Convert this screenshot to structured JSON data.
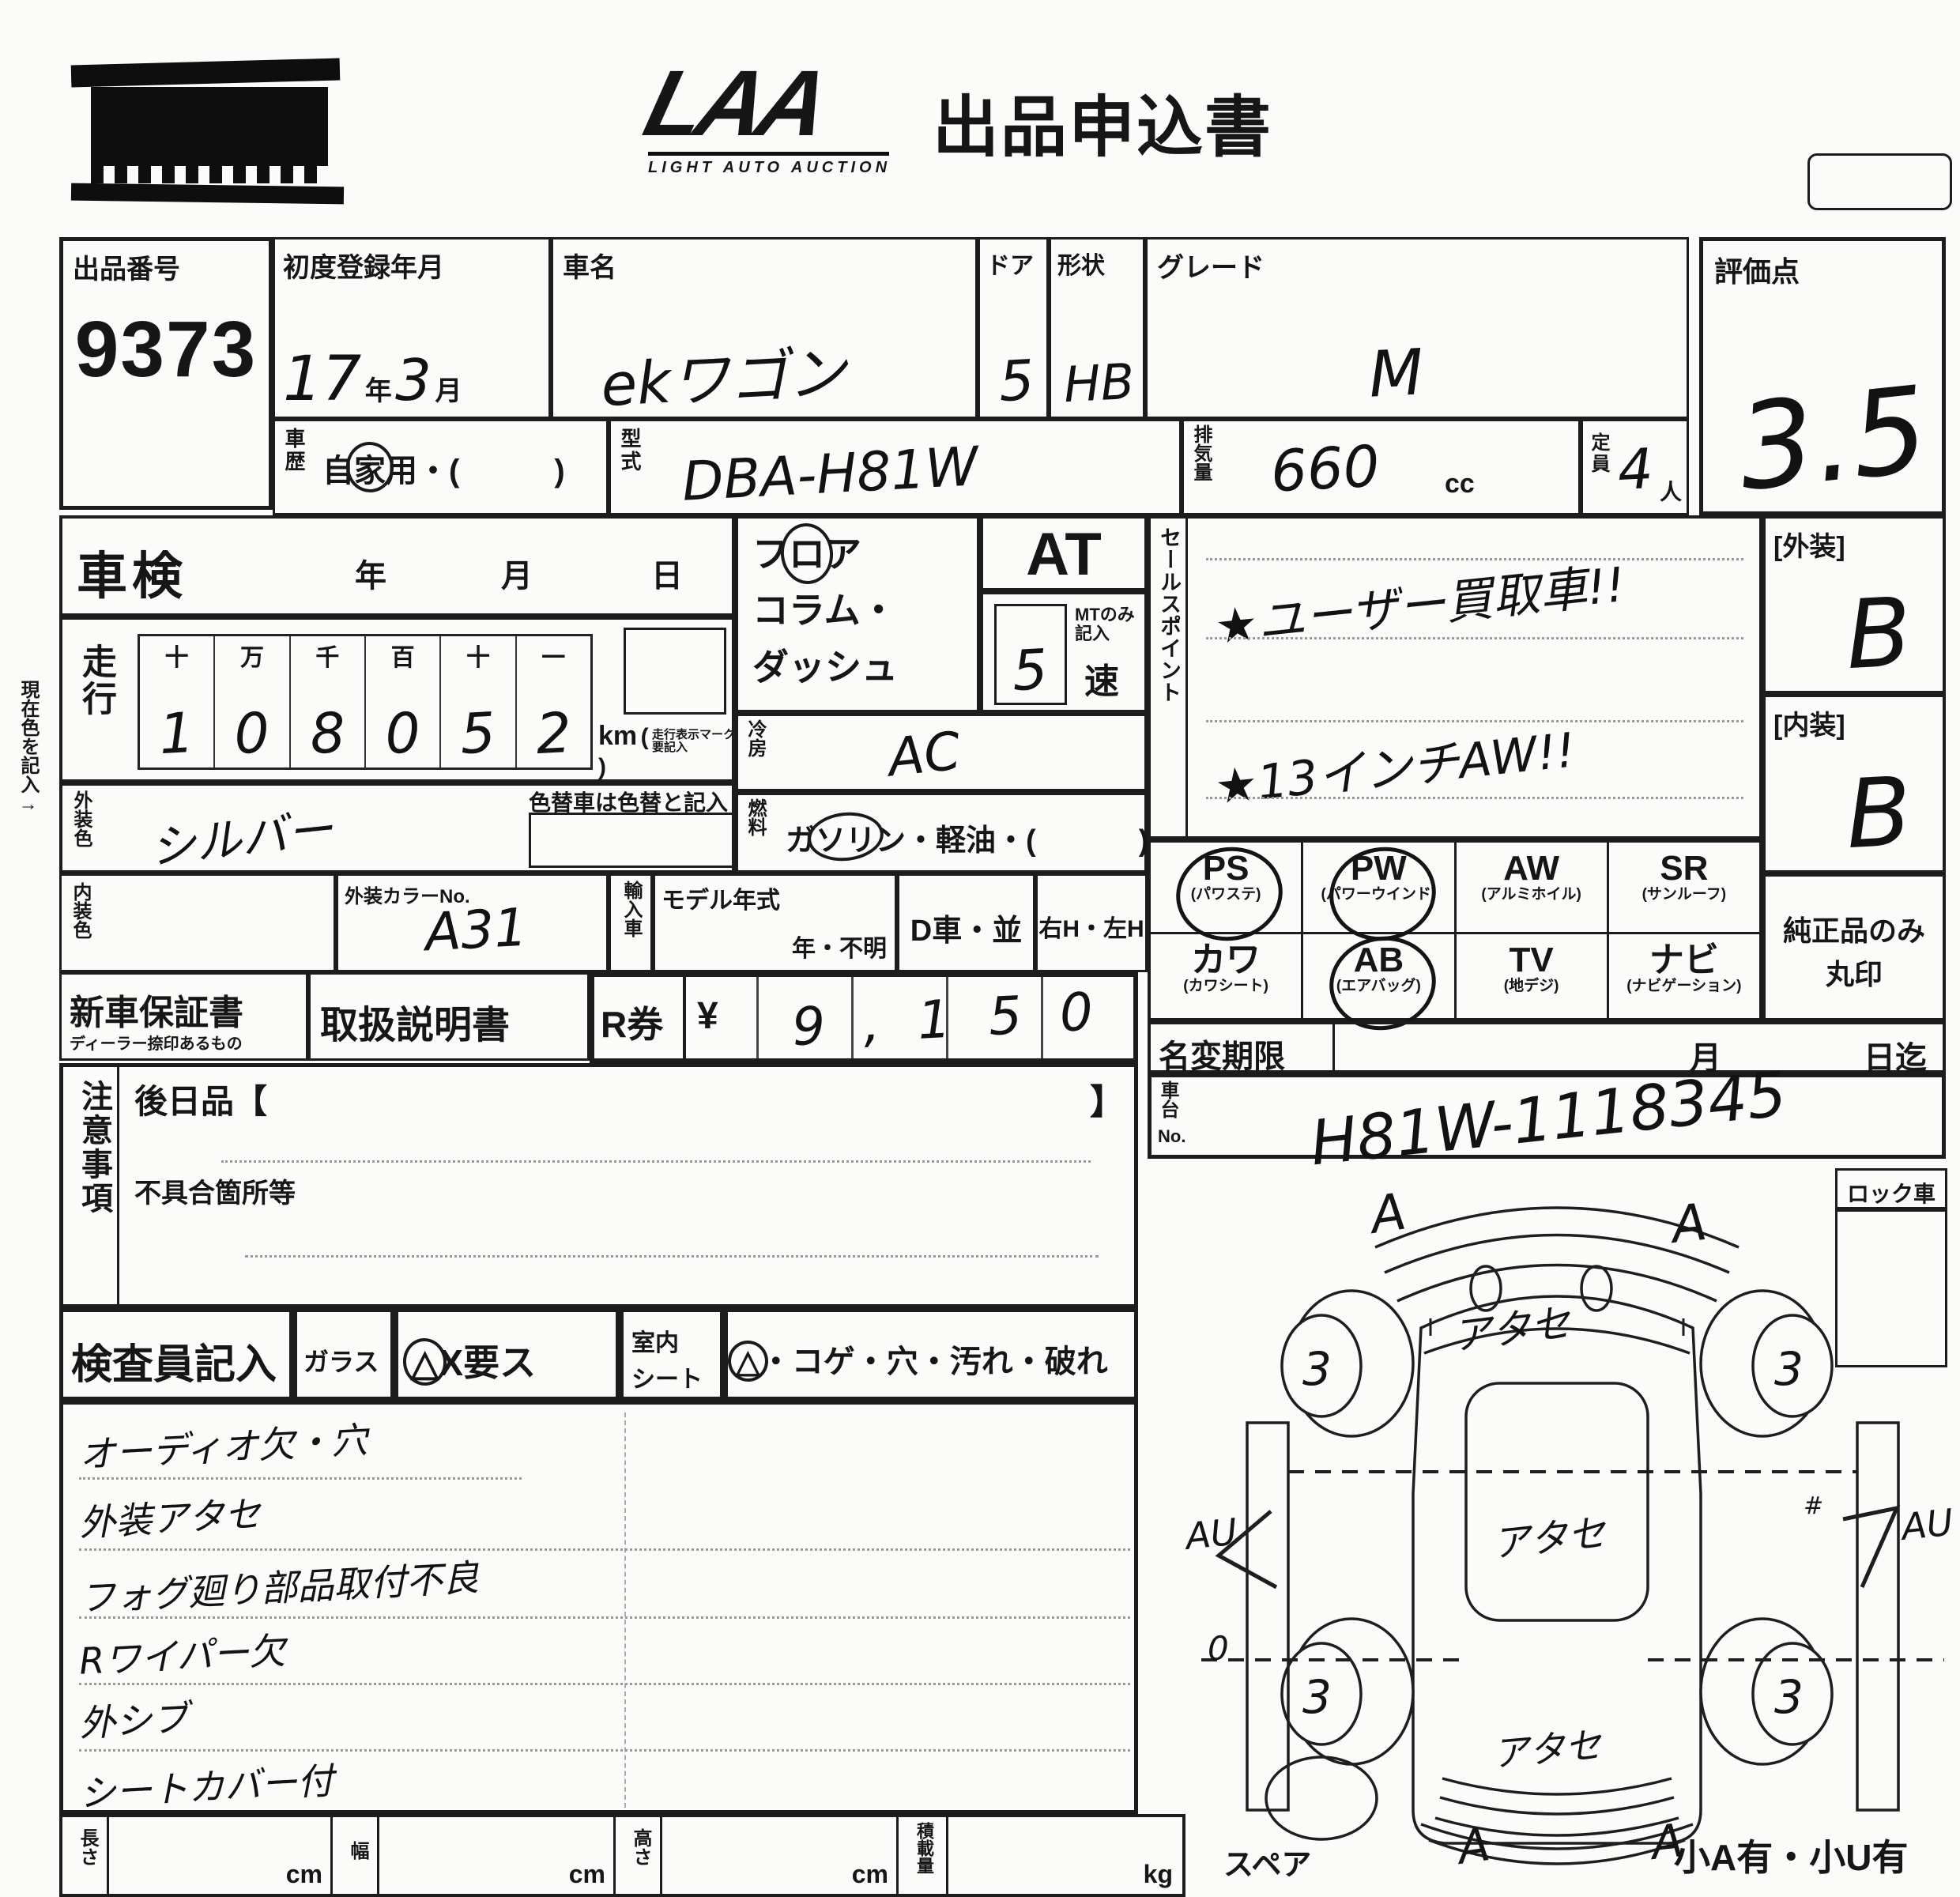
{
  "header": {
    "logo": "LAA",
    "logo_sub": "LIGHT AUTO AUCTION",
    "title": "出品申込書"
  },
  "top": {
    "lot_label": "出品番号",
    "lot_number": "9373",
    "reg_label": "初度登録年月",
    "reg_year": "17",
    "reg_year_unit": "年",
    "reg_month": "3",
    "reg_month_unit": "月",
    "name_label": "車名",
    "name_value": "ekワゴン",
    "door_label": "ドア",
    "door_value": "5",
    "shape_label": "形状",
    "shape_value": "HB",
    "grade_label": "グレード",
    "grade_value": "M",
    "score_label": "評価点",
    "score_value": "3.5"
  },
  "row2": {
    "history_label": "車歴",
    "history_p1": "自",
    "history_circled": "家",
    "history_p2": "用・(",
    "history_p3": ")",
    "model_label": "型式",
    "model_value": "DBA-H81W",
    "disp_label": "排気量",
    "disp_value": "660",
    "disp_unit": "cc",
    "cap_label": "定員",
    "cap_value": "4",
    "cap_unit": "人"
  },
  "left": {
    "shaken_label": "車検",
    "shaken_y": "年",
    "shaken_m": "月",
    "shaken_d": "日",
    "mileage_label": "走行",
    "odo_headers": [
      "十",
      "万",
      "千",
      "百",
      "十",
      "一"
    ],
    "odo_digits": [
      "1",
      "0",
      "8",
      "0",
      "5",
      "2"
    ],
    "odo_unit": "km",
    "odo_note1": "走行表示マーク",
    "odo_note2": "要記入",
    "current_color_note": "現在色を記入→",
    "ext_color_label": "外装色",
    "ext_color_value": "シルバー",
    "repaint_note": "色替車は色替と記入",
    "int_color_label": "内装色",
    "color_no_label": "外装カラーNo.",
    "color_no_value": "A31",
    "import_label": "輸入車",
    "model_year_label": "モデル年式",
    "model_year_opts": "年・不明",
    "d_car": "D車・並",
    "handle": "右H・左H",
    "warranty_label": "新車保証書",
    "warranty_sub": "ディーラー捺印あるもの",
    "manual_label": "取扱説明書",
    "rticket_label": "R券",
    "yen": "¥",
    "rticket_value": "9,150",
    "caution_label": "注意事項",
    "later_label": "後日品【",
    "bracket": "】",
    "defect_label": "不具合箇所等"
  },
  "mid": {
    "shift_p1": "フ",
    "shift_circled": "ロ",
    "shift_p2": "ア",
    "shift_l2": "コラム・",
    "shift_l3": "ダッシュ",
    "at": "AT",
    "mt_note1": "MTのみ",
    "mt_note2": "記入",
    "speed_value": "5",
    "speed_unit": "速",
    "cool_label": "冷房",
    "cool_value": "AC",
    "fuel_label": "燃料",
    "fuel_p1": "ガ",
    "fuel_circled": "ソリ",
    "fuel_p2": "ン・軽油・(",
    "fuel_p3": ")"
  },
  "sales": {
    "label": "セールスポイント",
    "points": [
      "★ユーザー買取車!!",
      "★13インチAW!!"
    ]
  },
  "equip": {
    "items": [
      {
        "code": "PS",
        "name": "(パワステ)",
        "circled": true
      },
      {
        "code": "PW",
        "name": "(パワーウインド)",
        "circled": true
      },
      {
        "code": "AW",
        "name": "(アルミホイル)",
        "circled": false
      },
      {
        "code": "SR",
        "name": "(サンルーフ)",
        "circled": false
      },
      {
        "code": "カワ",
        "name": "(カワシート)",
        "circled": false
      },
      {
        "code": "AB",
        "name": "(エアバッグ)",
        "circled": true
      },
      {
        "code": "TV",
        "name": "(地デジ)",
        "circled": false
      },
      {
        "code": "ナビ",
        "name": "(ナビゲーション)",
        "circled": false
      }
    ],
    "genuine_note1": "純正品のみ",
    "genuine_note2": "丸印"
  },
  "right": {
    "ext_grade_label": "[外装]",
    "ext_grade": "B",
    "int_grade_label": "[内装]",
    "int_grade": "B",
    "name_change_label": "名変期限",
    "name_change_m": "月",
    "name_change_d": "日迄",
    "chassis_label1": "車台",
    "chassis_label2": "No.",
    "chassis_value": "H81W-1118345",
    "lock_label": "ロック車"
  },
  "inspector": {
    "label": "検査員記入",
    "glass_label": "ガラス",
    "glass_tri": "△",
    "glass_opts": "X要ス",
    "seat_label1": "室内",
    "seat_label2": "シート",
    "seat_tri": "△",
    "seat_opts": "・コゲ・穴・汚れ・破れ",
    "notes": [
      "オーディオ欠・穴",
      "外装アタセ",
      "フォグ廻り部品取付不良",
      "Rワイパー欠",
      "外シブ",
      "シートカバー付"
    ]
  },
  "diagram": {
    "front_marks": [
      "A",
      "A"
    ],
    "rear_marks": [
      "A",
      "A"
    ],
    "panel_marks": [
      "アタセ",
      "アタセ",
      "アタセ"
    ],
    "wheel_values": [
      "3",
      "3",
      "3",
      "3"
    ],
    "side_left": "AU",
    "side_left_extra": "0",
    "side_right": "AU",
    "side_right_extra": "#",
    "side_right_arrow": "7",
    "spare_label": "スペア",
    "bottom_note": "小A有・小U有"
  },
  "measure": {
    "items": [
      {
        "label": "長さ",
        "unit": "cm"
      },
      {
        "label": "幅",
        "unit": "cm"
      },
      {
        "label": "高さ",
        "unit": "cm"
      },
      {
        "label": "積載量",
        "unit": "kg"
      }
    ]
  }
}
